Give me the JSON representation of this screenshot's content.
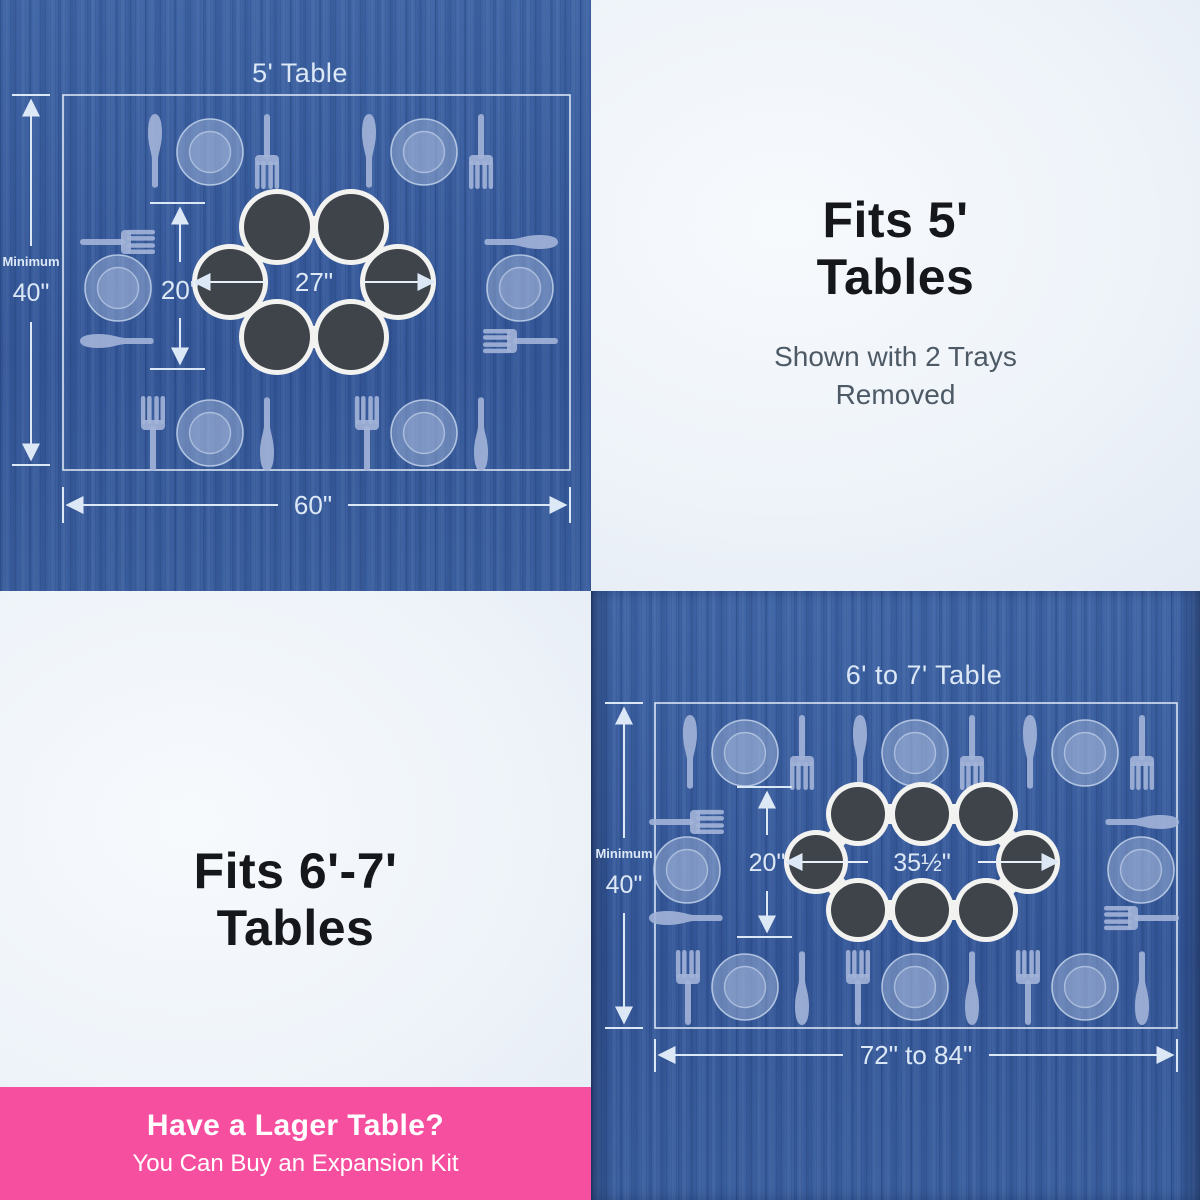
{
  "colors": {
    "wood_blue": "#3a5e9d",
    "light_panel": "#edf2f8",
    "banner_pink": "#f74f9f",
    "headline_text": "#15171b",
    "subnote_text": "#4d5965",
    "diagram_line": "#dce8f6",
    "plate_blue": "#9db0d6",
    "tray_dark": "#3f444a",
    "tray_base_white": "#f2f2f0"
  },
  "panel_5ft": {
    "title": "5' Table",
    "minimum_label": "Minimum",
    "minimum_value": "40\"",
    "table_width": "60\"",
    "tray_ring_height": "20\"",
    "tray_ring_width": "27\"",
    "tray_count": 6,
    "place_settings": 6
  },
  "fits_5ft": {
    "heading_line1": "Fits 5'",
    "heading_line2": "Tables",
    "note_line1": "Shown with 2 Trays",
    "note_line2": "Removed"
  },
  "fits_67ft": {
    "heading_line1": "Fits 6'-7'",
    "heading_line2": "Tables"
  },
  "banner": {
    "title": "Have a Lager Table?",
    "subtitle": "You Can Buy an Expansion Kit"
  },
  "panel_67ft": {
    "title": "6' to 7' Table",
    "minimum_label": "Minimum",
    "minimum_value": "40\"",
    "table_width": "72\" to 84\"",
    "tray_ring_height": "20\"",
    "tray_ring_width": "35½\"",
    "tray_count": 8,
    "place_settings": 8
  }
}
